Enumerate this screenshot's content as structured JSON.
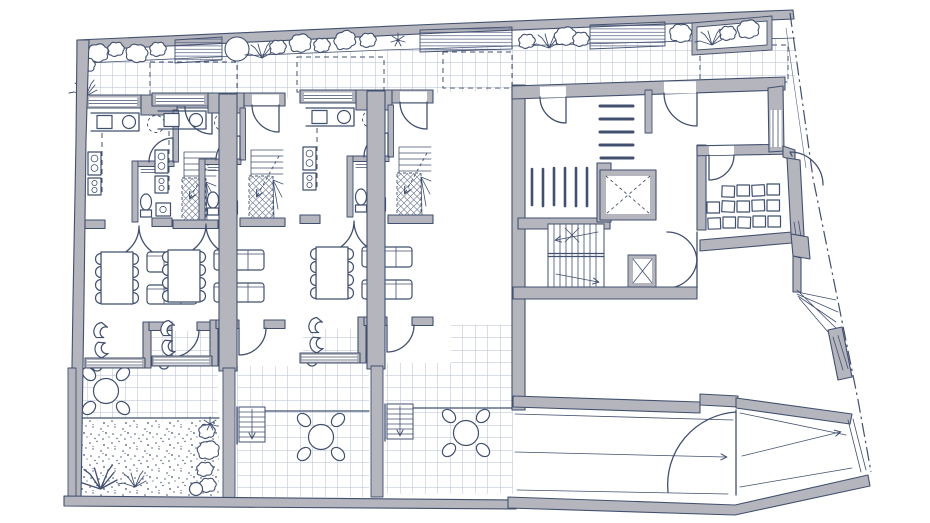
{
  "document": {
    "kind": "hand-drawn architectural floor plan sketch (scanned ink drawing)",
    "view": "ground floor plan of a terraced housing block with common core and driveway",
    "visible_text": "none",
    "units_count": 3
  },
  "palette": {
    "paper": "#ffffff",
    "ink": "#42506f",
    "ink_soft": "#5a6585",
    "wall_fill": "#b5b5bd",
    "tile_line": "#b4bed6",
    "hatch": "#4d5a7e"
  },
  "site": {
    "garden_strip": {
      "position": "top edge",
      "elements": [
        "shrub clusters",
        "hatched planting beds",
        "raised planter box at right",
        "round tree"
      ],
      "hatched_bed_count": 3
    },
    "walkway": {
      "surface": "square tile grid",
      "dashed_overhang_outlines": 4
    },
    "boundary": {
      "style": "dash-dot property line",
      "side": "right, diagonal"
    },
    "driveway": {
      "position": "bottom right",
      "lane_lines": 3,
      "direction_arrows": 2,
      "gate_swing": 1
    }
  },
  "units": [
    {
      "name": "townhouse-unit-1",
      "rooms": [
        "kitchen",
        "wc",
        "winder-stair",
        "living-dining"
      ],
      "furniture": {
        "dining_table": 1,
        "dining_chairs": 8,
        "sofas": 2,
        "lounge_chairs": 2,
        "patio_table": 1,
        "patio_chairs": 4
      },
      "outdoor": "tiled terrace + planted gravel garden"
    },
    {
      "name": "townhouse-unit-2",
      "rooms": [
        "kitchen",
        "wc",
        "winder-stair",
        "living-dining"
      ],
      "furniture": {
        "dining_table": 1,
        "dining_chairs": 8,
        "sofas": 2,
        "lounge_chairs": 2,
        "patio_table": 1,
        "patio_chairs": 4
      },
      "outdoor": "upper terrace, garden steps, lower tiled terrace"
    },
    {
      "name": "townhouse-unit-3",
      "rooms": [
        "kitchen",
        "wc",
        "winder-stair",
        "living-dining"
      ],
      "furniture": {
        "dining_table": 1,
        "dining_chairs": 8,
        "sofas": 2,
        "lounge_chairs": 2,
        "patio_table": 1,
        "patio_chairs": 4
      },
      "outdoor": "upper terrace, garden steps, lower tiled terrace"
    }
  ],
  "core": {
    "name": "common-core-and-hall",
    "rooms": [
      "entrance-hall",
      "bike-storage",
      "elevator",
      "stairwell",
      "service-shaft",
      "corridor",
      "upper-room",
      "locker-storage-room",
      "large-hall",
      "driveway-ramp"
    ],
    "bike_rack_bars": 6,
    "mailbox_bars": 5,
    "locker_squares": 14,
    "elevator_marking": "dashed X",
    "shaft_marking": "solid X",
    "stair_runs": 2
  }
}
